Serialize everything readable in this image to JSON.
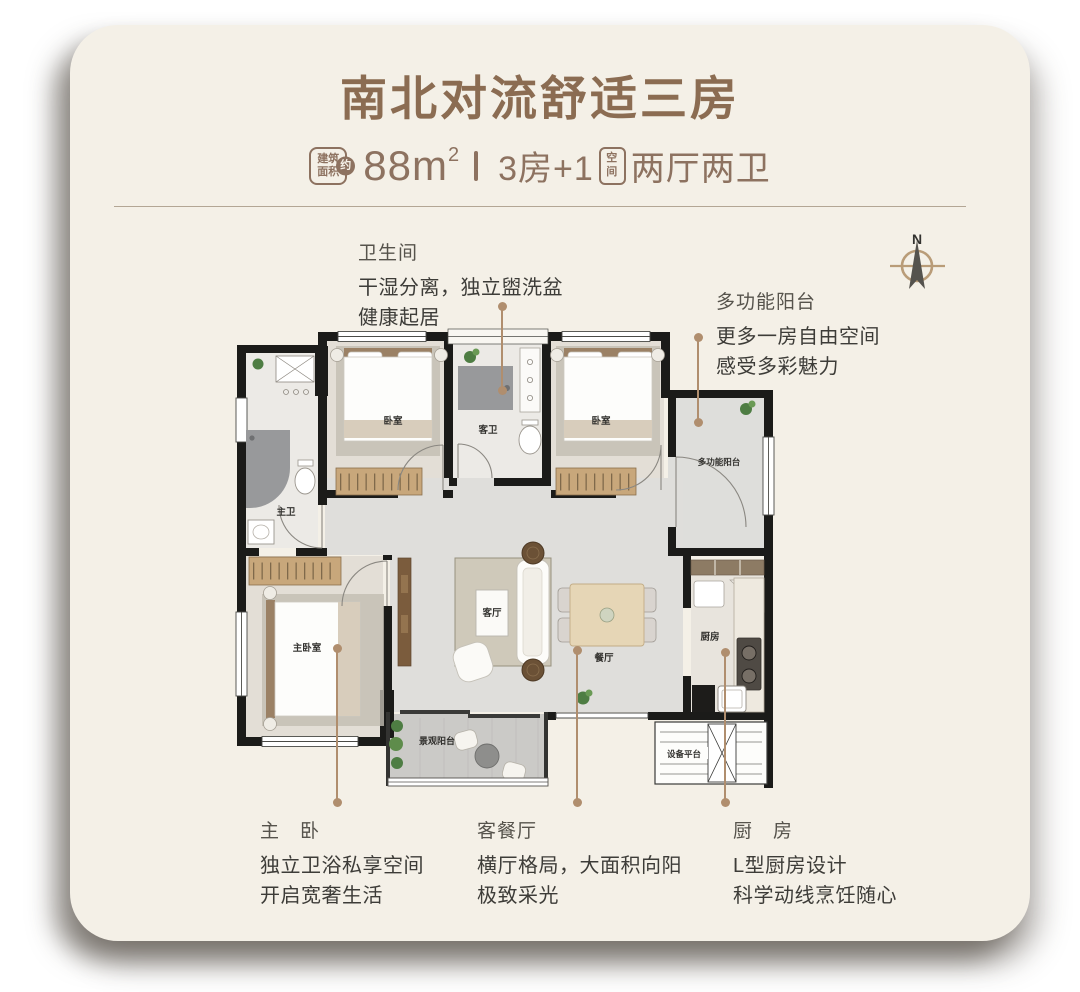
{
  "header": {
    "title": "南北对流舒适三房",
    "area_badge_line1": "建筑",
    "area_badge_line2": "面积",
    "area_badge_approx": "约",
    "area_value": "88m",
    "area_sup": "2",
    "spec_prefix": "3房+1",
    "spec_badge_line1": "空",
    "spec_badge_line2": "间",
    "spec_suffix": "两厅两卫"
  },
  "compass": {
    "north_label": "N"
  },
  "annotations": {
    "bathroom": {
      "title": "卫生间",
      "line1": "干湿分离，独立盥洗盆",
      "line2": "健康起居"
    },
    "multi_balcony": {
      "title": "多功能阳台",
      "line1": "更多一房自由空间",
      "line2": "感受多彩魅力"
    },
    "master": {
      "title": "主　卧",
      "line1": "独立卫浴私享空间",
      "line2": "开启宽奢生活"
    },
    "living": {
      "title": "客餐厅",
      "line1": "横厅格局，大面积向阳",
      "line2": "极致采光"
    },
    "kitchen": {
      "title": "厨　房",
      "line1": "L型厨房设计",
      "line2": "科学动线烹饪随心"
    }
  },
  "floorplan": {
    "rooms": {
      "bedroom_a": "卧室",
      "guest_bath": "客卫",
      "bedroom_b": "卧室",
      "multi_balcony": "多功能阳台",
      "master_bath": "主卫",
      "master_bedroom": "主卧室",
      "living": "客厅",
      "dining": "餐厅",
      "kitchen": "厨房",
      "view_balcony": "景观阳台",
      "equipment": "设备平台"
    }
  },
  "colors": {
    "accent_brown": "#8b6c52",
    "subtitle_brown": "#8d7260",
    "card_bg": "#f4f0e7",
    "leader_tan": "#b08e6e",
    "body_text": "#3d3c38"
  }
}
